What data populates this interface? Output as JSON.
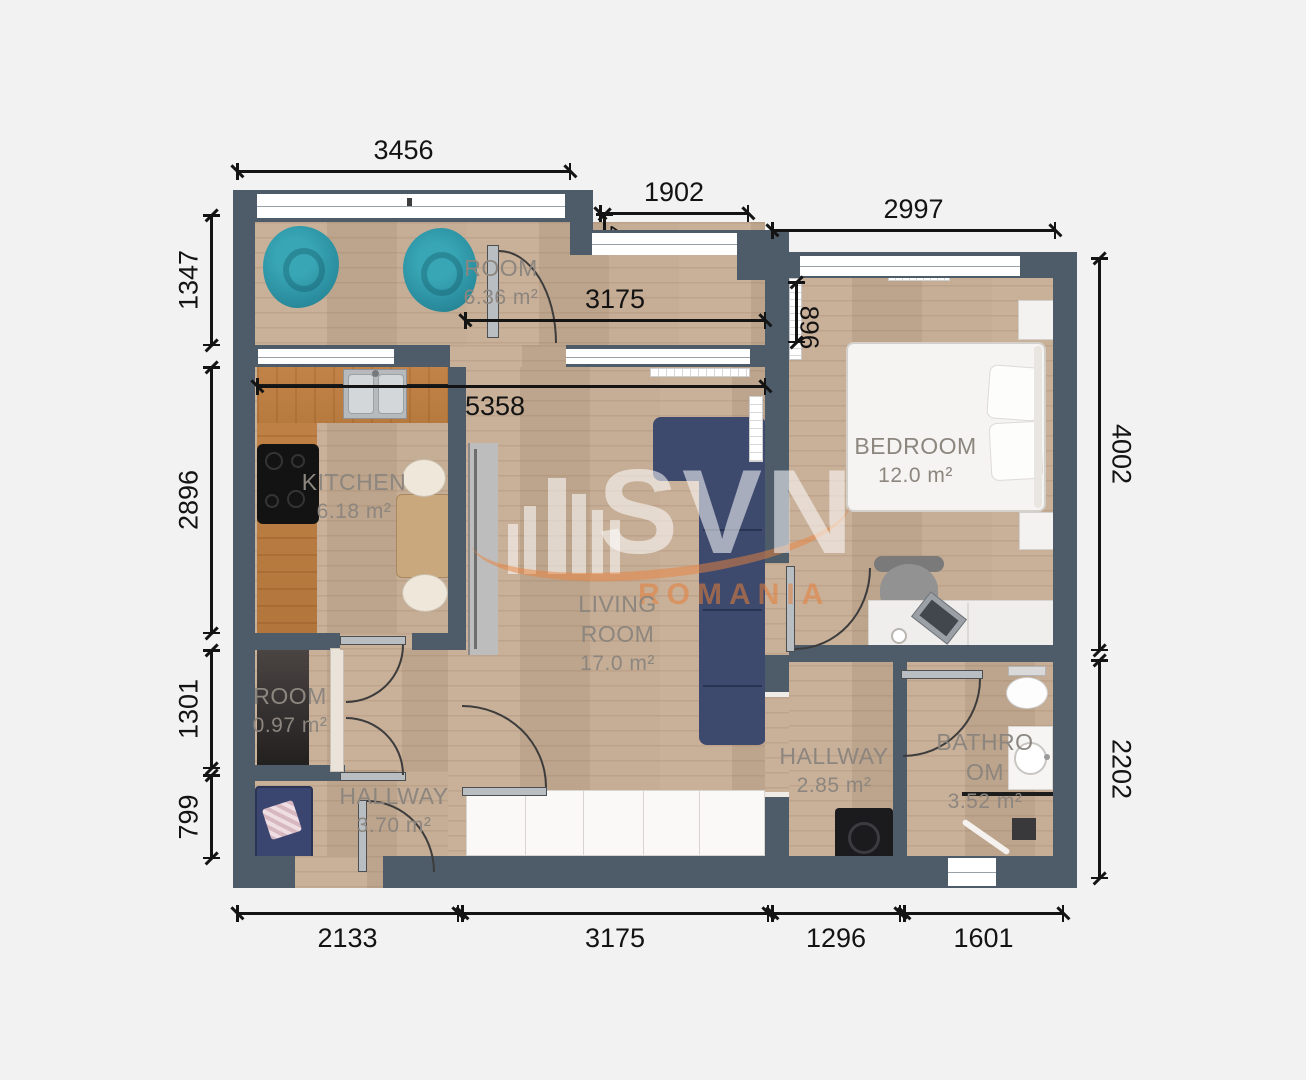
{
  "watermark": {
    "brand": "SVN",
    "region": "ROMANIA"
  },
  "rooms": {
    "balcony": {
      "name": "ROOM",
      "area": "6.36 m²"
    },
    "kitchen": {
      "name": "KITCHEN",
      "area": "6.18 m²"
    },
    "living": {
      "name": "LIVING ROOM",
      "area": "17.0 m²"
    },
    "bedroom": {
      "name": "BEDROOM",
      "area": "12.0 m²"
    },
    "closet": {
      "name": "ROOM",
      "area": "0.97 m²"
    },
    "hallway_main": {
      "name": "HALLWAY",
      "area": "3.70 m²"
    },
    "hallway_night": {
      "name": "HALLWAY",
      "area": "2.85 m²"
    },
    "bathroom": {
      "name": "BATHROOM",
      "area": "3.52 m²"
    }
  },
  "dimensions": {
    "balcony_width": "3456",
    "niche_width": "1902",
    "bedroom_width": "2997",
    "niche_side": "4",
    "bedroom_radiator": "896",
    "upper_living_width": "3175",
    "living_total_width": "5358",
    "balcony_height": "1347",
    "kitchen_height": "2896",
    "closet_height": "1301",
    "entry_height": "799",
    "bedroom_height": "4002",
    "bath_height": "2202",
    "bottom_left_width": "2133",
    "bottom_living_width": "3175",
    "bottom_hall_width": "1296",
    "bottom_bath_width": "1601"
  },
  "colors": {
    "wall": "#4e5c6a",
    "floor": "#c5ac93",
    "counter": "#bf8046",
    "accent_teal": "#2e96a5",
    "sofa_navy": "#3d4a6e",
    "watermark_orange": "#e87f37",
    "dimension_text": "#141414",
    "room_label": "#8c867f"
  }
}
